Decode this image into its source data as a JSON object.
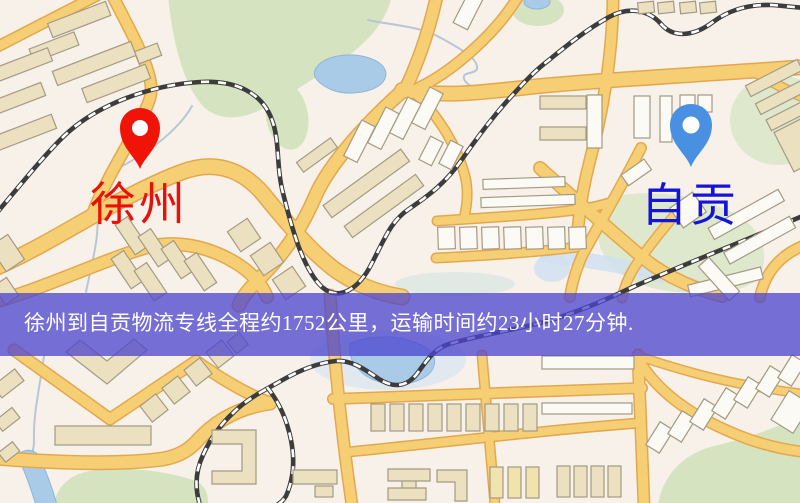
{
  "map": {
    "origin": {
      "label": "徐州",
      "label_color": "#e81109",
      "marker_color": "#f01408"
    },
    "destination": {
      "label": "自贡",
      "label_color": "#1414d8",
      "marker_color": "#4a90e2"
    },
    "banner": {
      "text": "徐州到自贡物流专线全程约1752公里，运输时间约23小时27分钟.",
      "text_color": "#ffffff",
      "background_color": "#4c44ce"
    },
    "route": {
      "origin_city": "徐州",
      "destination_city": "自贡",
      "distance_km": 1752,
      "duration_hours": 23,
      "duration_minutes": 27
    }
  }
}
